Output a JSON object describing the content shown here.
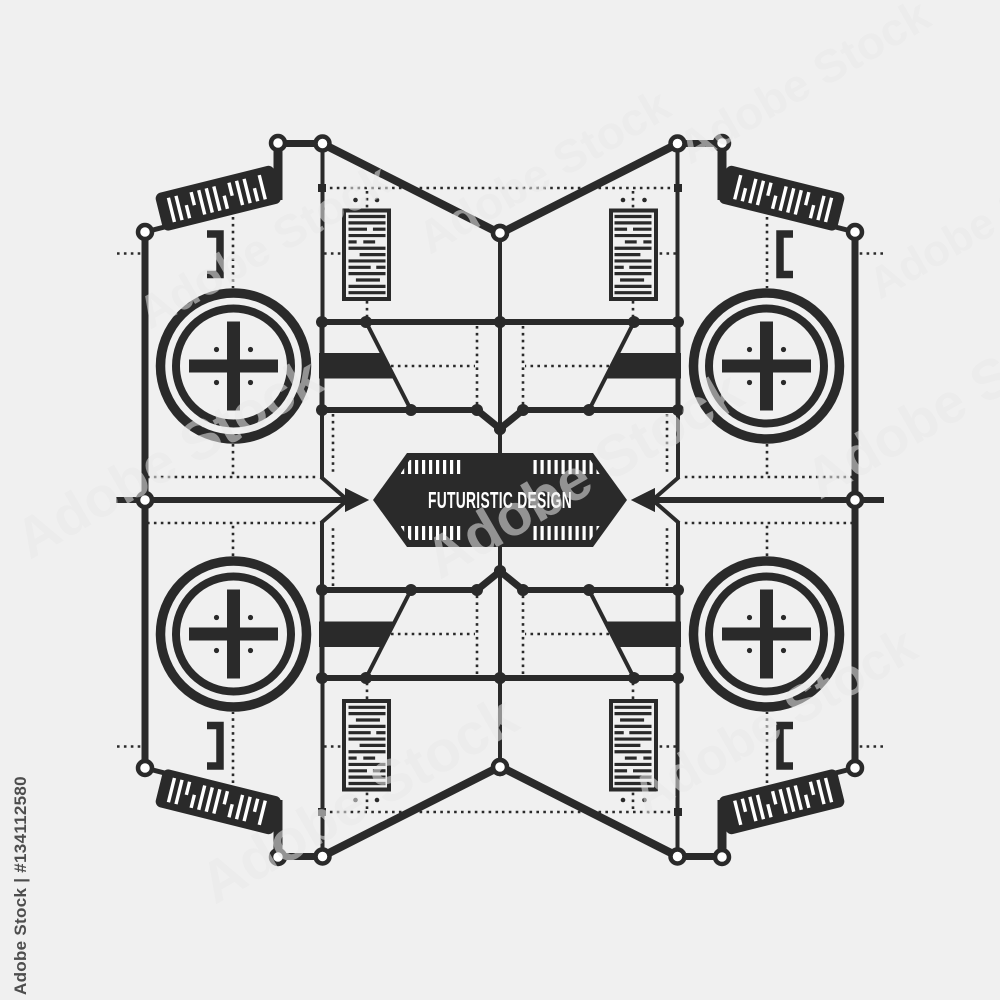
{
  "badge": {
    "title": "FUTURISTIC DESIGN"
  },
  "watermark": {
    "label": "Adobe Stock",
    "credit": "Adobe Stock | #134112580"
  },
  "colors": {
    "background": "#f0f0f0",
    "ink": "#2a2a2a",
    "badge_text": "#ffffff",
    "watermark": "#e9e9e9",
    "credit_text": "#4d4d4d"
  }
}
